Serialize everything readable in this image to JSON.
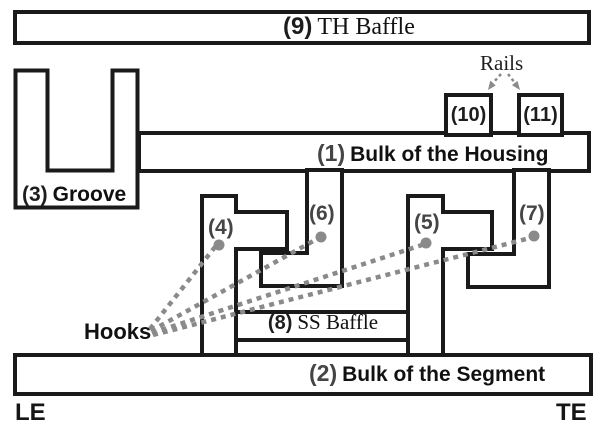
{
  "parts": {
    "th_baffle": {
      "number": "(9)",
      "name": "TH Baffle"
    },
    "housing": {
      "number": "(1)",
      "name": "Bulk of the Housing"
    },
    "segment": {
      "number": "(2)",
      "name": "Bulk of the Segment"
    },
    "groove": {
      "number": "(3)",
      "name": "Groove"
    },
    "hook_4": {
      "number": "(4)"
    },
    "hook_5": {
      "number": "(5)"
    },
    "hook_6": {
      "number": "(6)"
    },
    "hook_7": {
      "number": "(7)"
    },
    "ss_baffle": {
      "number": "(8)",
      "name": "SS Baffle"
    },
    "rail_10": {
      "number": "(10)"
    },
    "rail_11": {
      "number": "(11)"
    }
  },
  "annotations": {
    "rails_label": "Rails",
    "hooks_label": "Hooks",
    "le_label": "LE",
    "te_label": "TE"
  },
  "colors": {
    "outline": "#1a1a1a",
    "annotation_gray": "#8a8a8a",
    "background": "#ffffff"
  }
}
